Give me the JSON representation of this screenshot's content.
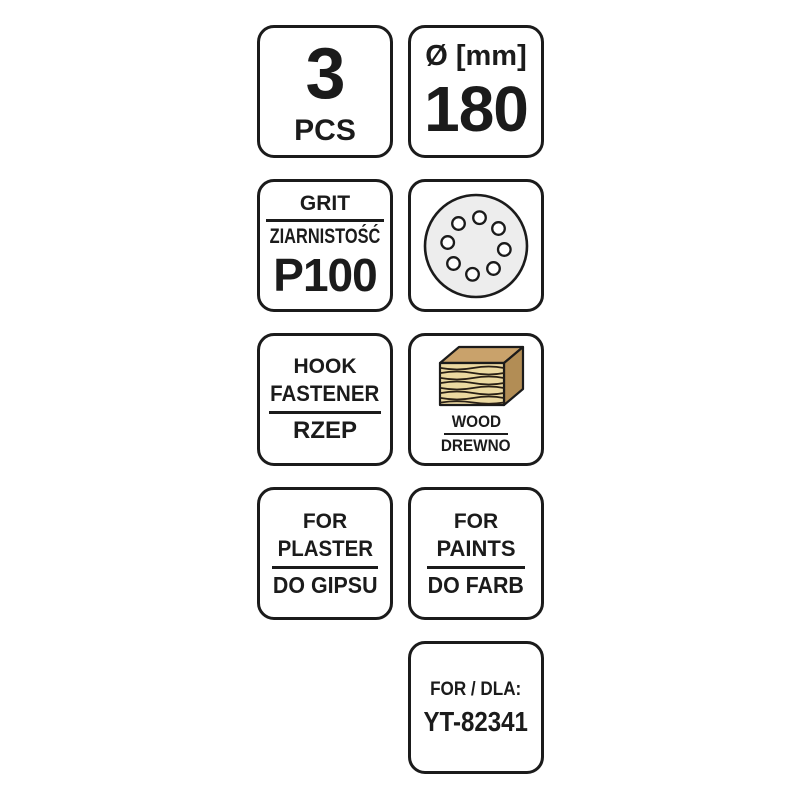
{
  "sheet": {
    "quantity": {
      "value": "3",
      "unit": "PCS"
    },
    "diameter": {
      "label": "Ø [mm]",
      "value": "180"
    },
    "grit": {
      "label_en": "GRIT",
      "label_pl": "ZIARNISTOŚĆ",
      "value": "P100"
    },
    "disc": {
      "icon": "sanding-disc-8-holes"
    },
    "fastener": {
      "line1": "HOOK",
      "line2": "FASTENER",
      "label_pl": "RZEP"
    },
    "material": {
      "icon": "wood-block",
      "label_en": "WOOD",
      "label_pl": "DREWNO"
    },
    "plaster": {
      "line1": "FOR",
      "line2": "PLASTER",
      "label_pl": "DO GIPSU"
    },
    "paints": {
      "line1": "FOR",
      "line2": "PAINTS",
      "label_pl": "DO FARB"
    },
    "model": {
      "label": "FOR / DLA:",
      "value": "YT-82341"
    }
  },
  "colors": {
    "ink": "#1b1b1b",
    "background": "#ffffff",
    "disc_fill": "#ededed",
    "hole_fill": "#ffffff",
    "wood_top": "#c9a26b",
    "wood_side": "#b28d55",
    "wood_front": "#ecd9a1",
    "wood_grain": "#2a2015"
  }
}
